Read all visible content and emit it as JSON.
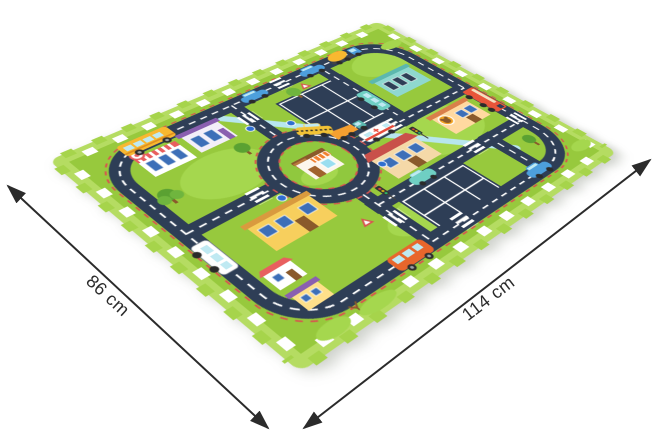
{
  "dimensions": {
    "depth_label": "86 cm",
    "width_label": "114 cm"
  },
  "illustration": {
    "subject": "foam puzzle play mat with city road map print",
    "elements": [
      "roundabout-shop",
      "school-bus",
      "taxi",
      "fire-truck",
      "cement-mixer-truck",
      "dump-truck",
      "ambulance",
      "orange-van",
      "white-van",
      "teal-minibus",
      "blue-cars",
      "parking-lots",
      "crosswalks",
      "traffic-signs",
      "trees",
      "bushes"
    ]
  },
  "palette": {
    "background": "#ffffff",
    "mat_green": "#97c93d",
    "mat_border_green": "#b5dc62",
    "tab_green": "#a6d44b",
    "grass_light": "#a5d74e",
    "road": "#2e3e56",
    "road_marking": "#ffffff",
    "curb_red": "#d9534f",
    "water_blue": "#b7e6ee",
    "bus_yellow": "#f8b830",
    "taxi_yellow": "#f2c236",
    "fire_truck_red": "#e8553a",
    "van_orange": "#e8662c",
    "car_blue": "#4d9fdc",
    "bus_teal": "#6fcfc3",
    "dimension_line": "#2b2b2b"
  }
}
